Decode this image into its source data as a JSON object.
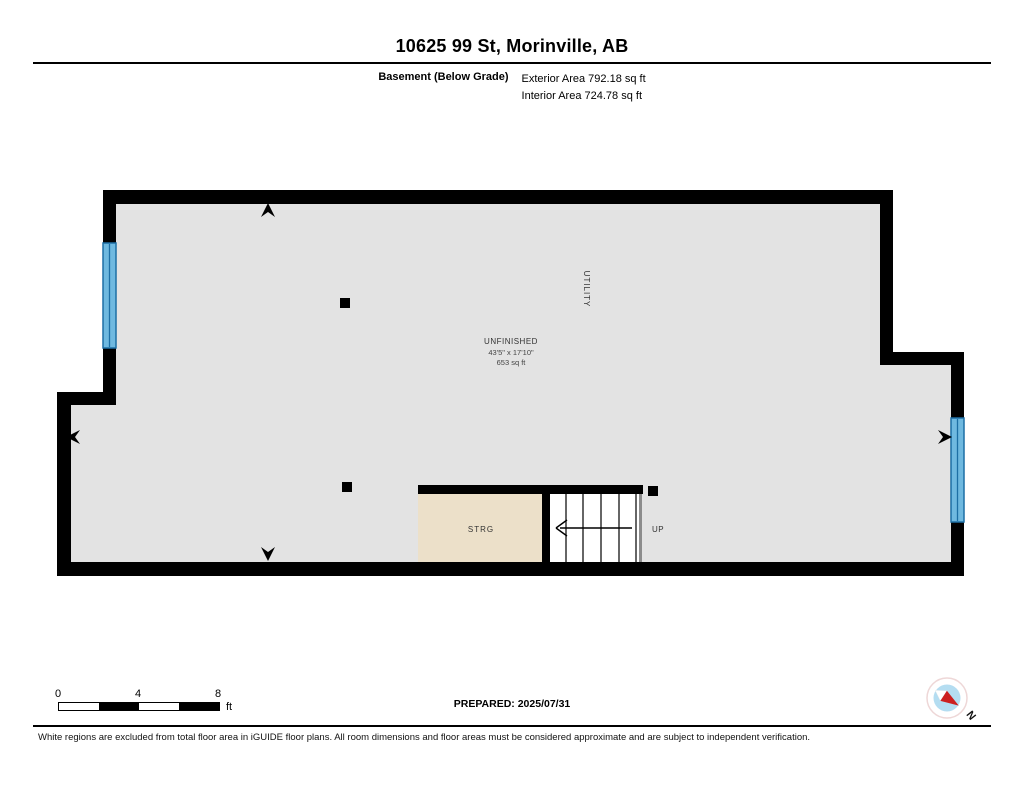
{
  "header": {
    "title": "10625 99 St, Morinville, AB",
    "floor_label": "Basement (Below Grade)",
    "exterior_area": "Exterior Area 792.18 sq ft",
    "interior_area": "Interior Area 724.78 sq ft"
  },
  "plan": {
    "rooms": {
      "unfinished": {
        "name": "UNFINISHED",
        "dimensions": "43'5\" x 17'10\"",
        "area": "653 sq ft"
      },
      "utility": {
        "name": "UTILITY"
      },
      "storage": {
        "name": "STRG"
      },
      "stairs": {
        "direction_label": "UP"
      }
    },
    "colors": {
      "wall": "#000000",
      "floor": "#e3e3e3",
      "storage_floor": "#ece0c9",
      "stairs_floor": "#ffffff",
      "window_fill": "#6fb9e0",
      "window_border": "#1d6fa5"
    }
  },
  "scale_bar": {
    "labels": [
      "0",
      "4",
      "8"
    ],
    "unit": "ft"
  },
  "footer": {
    "prepared": "PREPARED: 2025/07/31",
    "disclaimer": "White regions are excluded from total floor area in iGUIDE floor plans. All room dimensions and floor areas must be considered approximate and are subject to independent verification."
  },
  "compass": {
    "north_label": "N",
    "needle_color": "#cc1f1f"
  }
}
